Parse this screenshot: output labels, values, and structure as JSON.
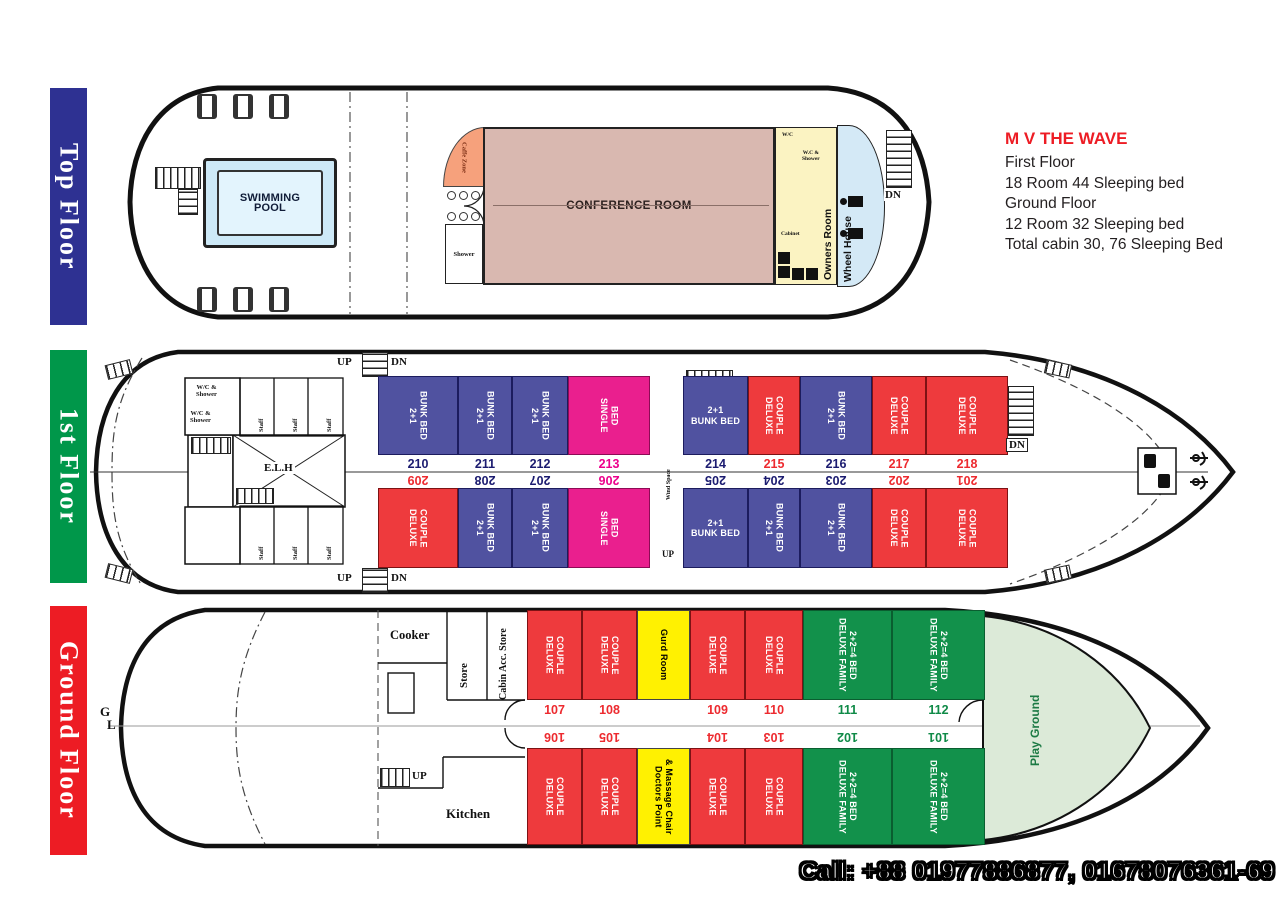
{
  "info": {
    "title": "M V THE WAVE",
    "lines": [
      "First Floor",
      "18 Room  44 Sleeping bed",
      "Ground Floor",
      "12 Room 32 Sleeping bed",
      "Total cabin 30, 76 Sleeping Bed"
    ]
  },
  "banners": {
    "top": "Top Floor",
    "first": "1st Floor",
    "ground": "Ground Floor"
  },
  "footer": {
    "call": "Call: +88 01977886877, 01678076361-69"
  },
  "top_floor": {
    "swimming_pool": "SWIMMING\nPOOL",
    "caffe_zone": "Caffe Zone",
    "shower": "Shower",
    "conference_room": "CONFERENCE ROOM",
    "owners_room": "Owners Room",
    "wheel_house": "Wheel House",
    "wc": "W/C",
    "wc_shower": "W.C &\nShower",
    "cabinet": "Cabinet",
    "dn": "DN"
  },
  "first_floor": {
    "up": "UP",
    "dn": "DN",
    "elh": "E.L.H",
    "wind_space": "Wind Space",
    "staff": "Staff",
    "wc_shower": "W/C &\nShower",
    "rooms_top": [
      {
        "num": "210",
        "type": "2+1\nBUNK BED"
      },
      {
        "num": "211",
        "type": "2+1\nBUNK BED"
      },
      {
        "num": "212",
        "type": "2+1\nBUNK BED"
      },
      {
        "num": "213",
        "type": "SINGLE\nBED"
      },
      {
        "num": "214",
        "type": "2+1\nBUNK BED"
      },
      {
        "num": "215",
        "type": "DELUXE\nCOUPLE"
      },
      {
        "num": "216",
        "type": "2+1\nBUNK BED"
      },
      {
        "num": "217",
        "type": "DELUXE\nCOUPLE"
      },
      {
        "num": "218",
        "type": "DELUXE\nCOUPLE"
      }
    ],
    "rooms_bottom": [
      {
        "num": "209",
        "type": "DELUXE\nCOUPLE"
      },
      {
        "num": "208",
        "type": "2+1\nBUNK BED"
      },
      {
        "num": "207",
        "type": "2+1\nBUNK BED"
      },
      {
        "num": "206",
        "type": "SINGLE\nBED"
      },
      {
        "num": "205",
        "type": "2+1\nBUNK BED"
      },
      {
        "num": "204",
        "type": "2+1\nBUNK BED"
      },
      {
        "num": "203",
        "type": "2+1\nBUNK BED"
      },
      {
        "num": "202",
        "type": "DELUXE\nCOUPLE"
      },
      {
        "num": "201",
        "type": "DELUXE\nCOUPLE"
      }
    ]
  },
  "ground_floor": {
    "cooker": "Cooker",
    "store": "Store",
    "cabin_acc_store": "Cabin Acc. Store",
    "kitchen": "Kitchen",
    "up": "UP",
    "center_g": "G",
    "center_l": "L",
    "gurd_room": "Gurd Room",
    "doctors_point": "Doctors Point\n& Massage Chair",
    "play_ground": "Play Ground",
    "rooms_top": [
      {
        "num": "107",
        "type": "DELUXE\nCOUPLE"
      },
      {
        "num": "108",
        "type": "DELUXE\nCOUPLE"
      },
      {
        "num": "109",
        "type": "DELUXE\nCOUPLE"
      },
      {
        "num": "110",
        "type": "DELUXE\nCOUPLE"
      },
      {
        "num": "111",
        "type": "DELUXE FAMILY\n2+2=4 BED"
      },
      {
        "num": "112",
        "type": "DELUXE FAMILY\n2+2=4 BED"
      }
    ],
    "rooms_bottom": [
      {
        "num": "106",
        "type": "DELUXE\nCOUPLE"
      },
      {
        "num": "105",
        "type": "DELUXE\nCOUPLE"
      },
      {
        "num": "104",
        "type": "DELUXE\nCOUPLE"
      },
      {
        "num": "103",
        "type": "DELUXE\nCOUPLE"
      },
      {
        "num": "102",
        "type": "DELUXE FAMILY\n2+2=4 BED"
      },
      {
        "num": "101",
        "type": "DELUXE FAMILY\n2+2=4 BED"
      }
    ]
  },
  "colors": {
    "banner_blue": "#2e3192",
    "banner_green": "#00974a",
    "banner_red": "#ed1c24",
    "bunk_blue": "#5052a0",
    "deluxe_red": "#ee3a3d",
    "single_magenta": "#ea1f8e",
    "family_green": "#12914b",
    "service_yellow": "#fff101",
    "conference_tan": "#d9b8b0",
    "owners_yellow": "#fbf3c2",
    "wheelhouse_blue": "#d4e9f6",
    "caffe_orange": "#f6a17c",
    "pool_blue": "#cde9f7",
    "playground_green": "#dcead8",
    "title_red": "#ed1c24"
  }
}
